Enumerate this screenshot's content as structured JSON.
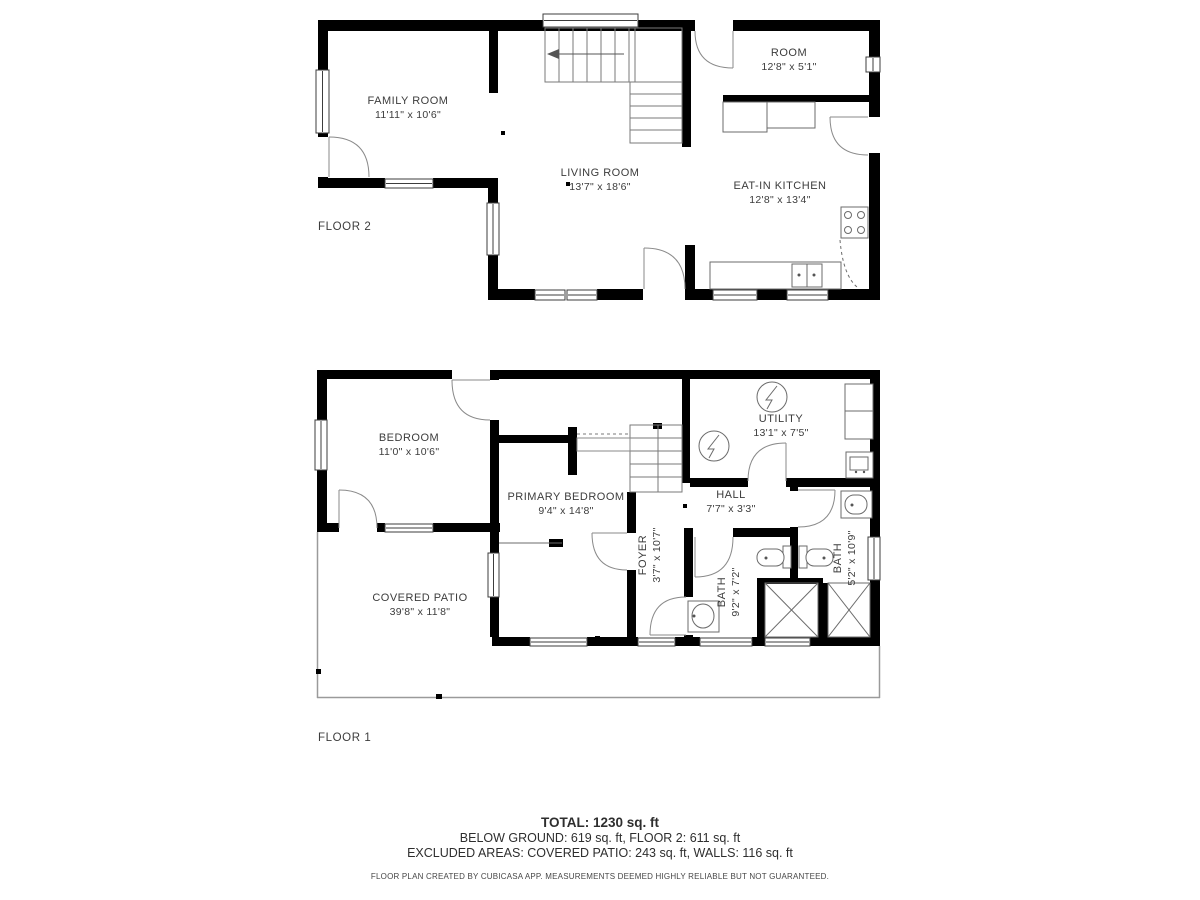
{
  "floor2": {
    "label": "FLOOR 2",
    "rooms": {
      "family": {
        "name": "FAMILY ROOM",
        "dims": "11'11\" x 10'6\""
      },
      "living": {
        "name": "LIVING ROOM",
        "dims": "13'7\" x 18'6\""
      },
      "room": {
        "name": "ROOM",
        "dims": "12'8\" x 5'1\""
      },
      "kitchen": {
        "name": "EAT-IN KITCHEN",
        "dims": "12'8\" x 13'4\""
      }
    }
  },
  "floor1": {
    "label": "FLOOR 1",
    "rooms": {
      "bedroom": {
        "name": "BEDROOM",
        "dims": "11'0\" x 10'6\""
      },
      "primary": {
        "name": "PRIMARY BEDROOM",
        "dims": "9'4\" x 14'8\""
      },
      "foyer": {
        "name": "FOYER",
        "dims": "3'7\" x 10'7\""
      },
      "hall": {
        "name": "HALL",
        "dims": "7'7\" x 3'3\""
      },
      "utility": {
        "name": "UTILITY",
        "dims": "13'1\" x 7'5\""
      },
      "bath1": {
        "name": "BATH",
        "dims": "9'2\" x 7'2\""
      },
      "bath2": {
        "name": "BATH",
        "dims": "5'2\" x 10'9\""
      },
      "patio": {
        "name": "COVERED PATIO",
        "dims": "39'8\" x 11'8\""
      }
    }
  },
  "summary": {
    "total": "TOTAL: 1230 sq. ft",
    "areas": "BELOW GROUND: 619 sq. ft, FLOOR 2: 611 sq. ft",
    "excluded": "EXCLUDED AREAS: COVERED PATIO: 243 sq. ft, WALLS: 116 sq. ft",
    "disclaimer": "FLOOR PLAN CREATED BY CUBICASA APP. MEASUREMENTS DEEMED HIGHLY RELIABLE BUT NOT GUARANTEED."
  }
}
